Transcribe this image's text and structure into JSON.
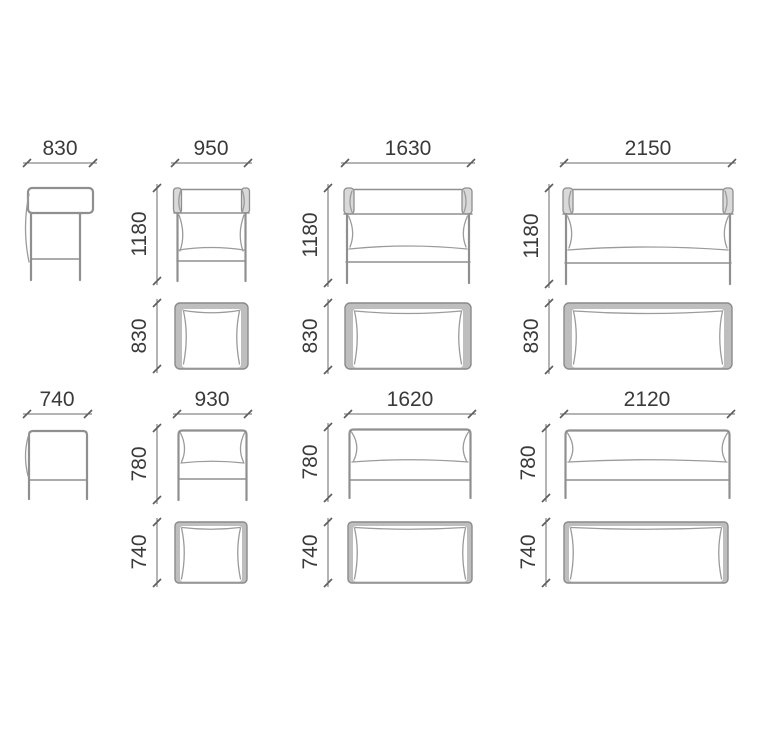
{
  "diagram": {
    "title": "Sofa dimension drawings",
    "colors": {
      "background": "#ffffff",
      "line": "#8f8f8f",
      "cushion_line": "#9b9b9b",
      "top_view_band": "#bebebe",
      "dimension_line": "#6a6a6a",
      "text": "#3a3a3a"
    },
    "high_back": {
      "side": {
        "width": "830"
      },
      "fronts": [
        {
          "width": "950",
          "height": "1180"
        },
        {
          "width": "1630",
          "height": "1180"
        },
        {
          "width": "2150",
          "height": "1180"
        }
      ],
      "tops": [
        {
          "depth": "830"
        },
        {
          "depth": "830"
        },
        {
          "depth": "830"
        }
      ]
    },
    "low_back": {
      "side": {
        "width": "740"
      },
      "fronts": [
        {
          "width": "930",
          "height": "780"
        },
        {
          "width": "1620",
          "height": "780"
        },
        {
          "width": "2120",
          "height": "780"
        }
      ],
      "tops": [
        {
          "depth": "740"
        },
        {
          "depth": "740"
        },
        {
          "depth": "740"
        }
      ]
    }
  }
}
